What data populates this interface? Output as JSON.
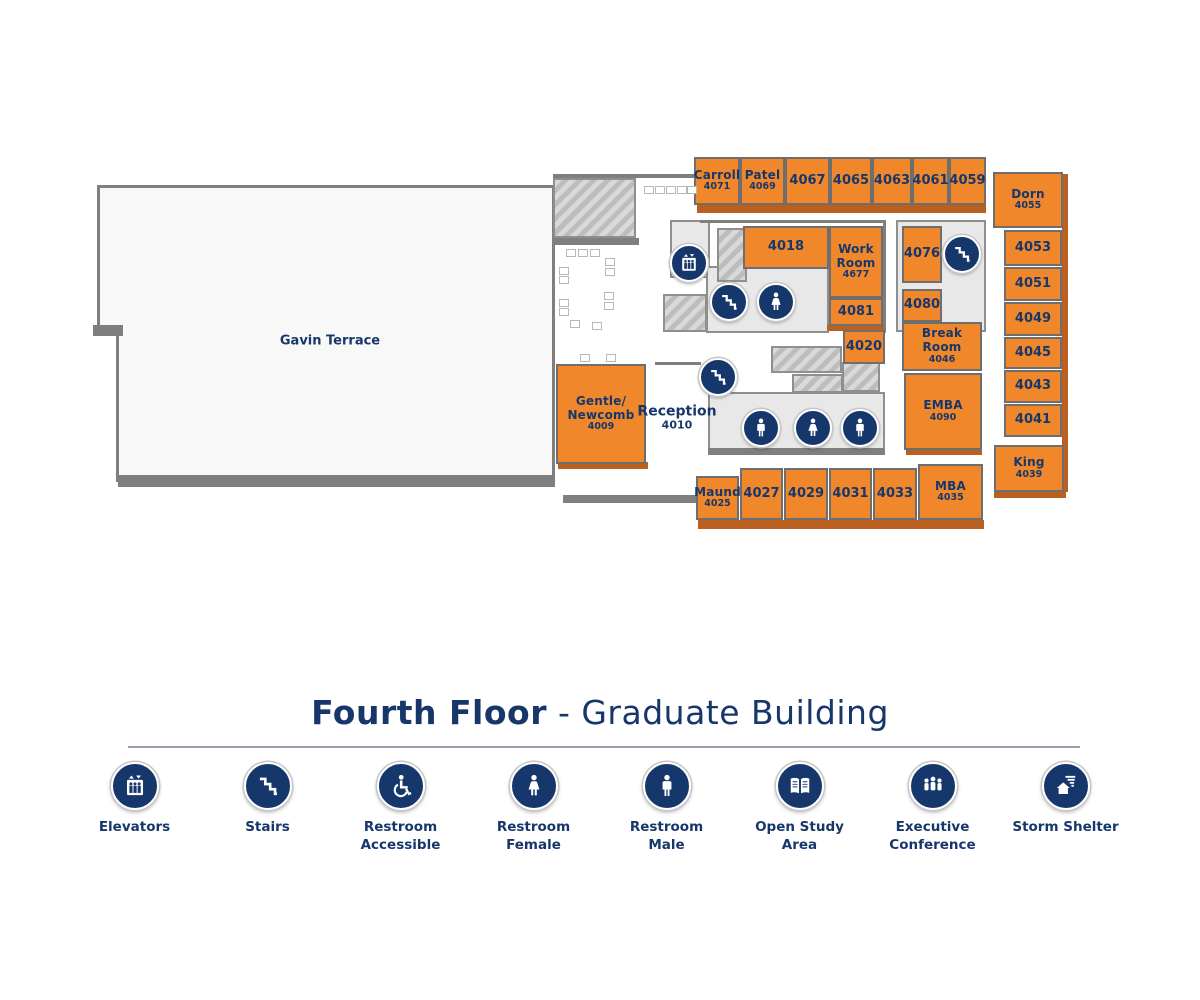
{
  "title": {
    "primary": "Fourth Floor",
    "separator": " - ",
    "secondary": "Graduate Building"
  },
  "colors": {
    "room_orange": "#f0882b",
    "room_shadow": "#b95f1f",
    "navy": "#17376b",
    "wall_gray": "#7f7f7f"
  },
  "map": {
    "rooms": [
      {
        "lines": [
          "Carroll",
          "4071"
        ],
        "x": 694,
        "y": 157,
        "w": 46,
        "h": 48
      },
      {
        "lines": [
          "Patel",
          "4069"
        ],
        "x": 740,
        "y": 157,
        "w": 45,
        "h": 48
      },
      {
        "lines": [
          "4067"
        ],
        "x": 785,
        "y": 157,
        "w": 45,
        "h": 48
      },
      {
        "lines": [
          "4065"
        ],
        "x": 830,
        "y": 157,
        "w": 42,
        "h": 48
      },
      {
        "lines": [
          "4063"
        ],
        "x": 872,
        "y": 157,
        "w": 40,
        "h": 48
      },
      {
        "lines": [
          "4061"
        ],
        "x": 912,
        "y": 157,
        "w": 37,
        "h": 48
      },
      {
        "lines": [
          "4059"
        ],
        "x": 949,
        "y": 157,
        "w": 37,
        "h": 48
      },
      {
        "lines": [
          "Dorn",
          "4055"
        ],
        "x": 993,
        "y": 172,
        "w": 70,
        "h": 56
      },
      {
        "lines": [
          "4053"
        ],
        "x": 1004,
        "y": 230,
        "w": 58,
        "h": 36
      },
      {
        "lines": [
          "4051"
        ],
        "x": 1004,
        "y": 267,
        "w": 58,
        "h": 34
      },
      {
        "lines": [
          "4049"
        ],
        "x": 1004,
        "y": 302,
        "w": 58,
        "h": 34
      },
      {
        "lines": [
          "4045"
        ],
        "x": 1004,
        "y": 337,
        "w": 58,
        "h": 32
      },
      {
        "lines": [
          "4043"
        ],
        "x": 1004,
        "y": 370,
        "w": 58,
        "h": 33
      },
      {
        "lines": [
          "4041"
        ],
        "x": 1004,
        "y": 404,
        "w": 58,
        "h": 33
      },
      {
        "lines": [
          "King",
          "4039"
        ],
        "x": 994,
        "y": 445,
        "w": 70,
        "h": 47
      },
      {
        "lines": [
          "4018"
        ],
        "x": 743,
        "y": 226,
        "w": 86,
        "h": 43
      },
      {
        "lines": [
          "Work",
          "Room",
          "4677"
        ],
        "x": 829,
        "y": 226,
        "w": 54,
        "h": 72
      },
      {
        "lines": [
          "4081"
        ],
        "x": 829,
        "y": 298,
        "w": 54,
        "h": 28
      },
      {
        "lines": [
          "4020"
        ],
        "x": 843,
        "y": 330,
        "w": 42,
        "h": 34
      },
      {
        "lines": [
          "4076"
        ],
        "x": 902,
        "y": 226,
        "w": 40,
        "h": 57
      },
      {
        "lines": [
          "4080"
        ],
        "x": 902,
        "y": 289,
        "w": 40,
        "h": 33
      },
      {
        "lines": [
          "Break Room",
          "4046"
        ],
        "x": 902,
        "y": 322,
        "w": 80,
        "h": 49
      },
      {
        "lines": [
          "EMBA",
          "4090"
        ],
        "x": 904,
        "y": 373,
        "w": 78,
        "h": 77
      },
      {
        "lines": [
          "Gentle/",
          "Newcomb",
          "4009"
        ],
        "x": 556,
        "y": 364,
        "w": 90,
        "h": 100
      },
      {
        "lines": [
          "Maund",
          "4025"
        ],
        "x": 696,
        "y": 476,
        "w": 43,
        "h": 44
      },
      {
        "lines": [
          "4027"
        ],
        "x": 740,
        "y": 468,
        "w": 43,
        "h": 52
      },
      {
        "lines": [
          "4029"
        ],
        "x": 784,
        "y": 468,
        "w": 44,
        "h": 52
      },
      {
        "lines": [
          "4031"
        ],
        "x": 829,
        "y": 468,
        "w": 43,
        "h": 52
      },
      {
        "lines": [
          "4033"
        ],
        "x": 873,
        "y": 468,
        "w": 44,
        "h": 52
      },
      {
        "lines": [
          "MBA",
          "4035"
        ],
        "x": 918,
        "y": 464,
        "w": 65,
        "h": 56
      }
    ],
    "labels": [
      {
        "lines": [
          "Gavin Terrace"
        ],
        "x": 330,
        "y": 342,
        "size": 13
      },
      {
        "lines": [
          "Reception",
          "4010"
        ],
        "x": 677,
        "y": 418,
        "size": 14
      }
    ],
    "icons": [
      {
        "type": "elevator",
        "x": 689,
        "y": 263
      },
      {
        "type": "stairs",
        "x": 729,
        "y": 302
      },
      {
        "type": "female",
        "x": 776,
        "y": 302
      },
      {
        "type": "stairs",
        "x": 962,
        "y": 254
      },
      {
        "type": "stairs",
        "x": 718,
        "y": 377
      },
      {
        "type": "male",
        "x": 761,
        "y": 428
      },
      {
        "type": "female",
        "x": 813,
        "y": 428
      },
      {
        "type": "male",
        "x": 860,
        "y": 428
      }
    ]
  },
  "legend": [
    {
      "icon": "elevator",
      "lines": [
        "Elevators"
      ]
    },
    {
      "icon": "stairs",
      "lines": [
        "Stairs"
      ]
    },
    {
      "icon": "accessible",
      "lines": [
        "Restroom",
        "Accessible"
      ]
    },
    {
      "icon": "female",
      "lines": [
        "Restroom",
        "Female"
      ]
    },
    {
      "icon": "male",
      "lines": [
        "Restroom",
        "Male"
      ]
    },
    {
      "icon": "book",
      "lines": [
        "Open Study",
        "Area"
      ]
    },
    {
      "icon": "executive",
      "lines": [
        "Executive",
        "Conference"
      ]
    },
    {
      "icon": "shelter",
      "lines": [
        "Storm Shelter"
      ]
    }
  ]
}
